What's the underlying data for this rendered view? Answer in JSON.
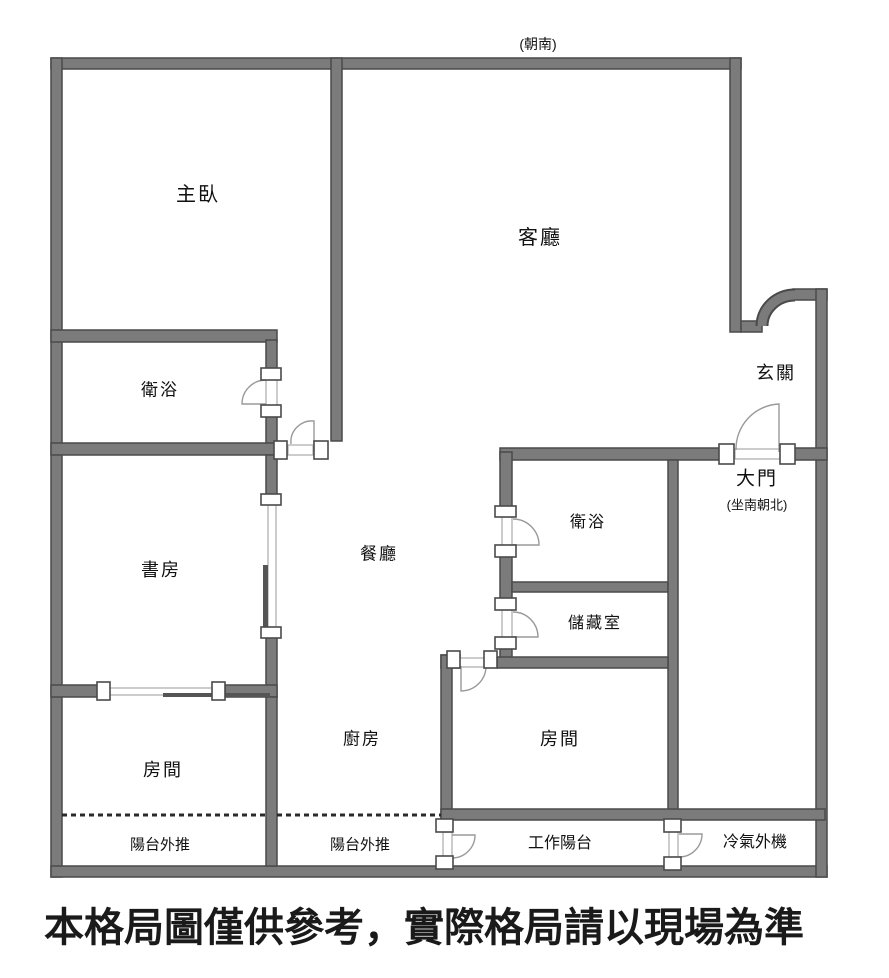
{
  "plan": {
    "orientation_label": "(朝南)",
    "entrance": {
      "door_label": "大門",
      "door_sub_label": "(坐南朝北)"
    },
    "rooms": [
      {
        "name": "master-bedroom",
        "label": "主臥"
      },
      {
        "name": "living-room",
        "label": "客廳"
      },
      {
        "name": "bathroom-1",
        "label": "衛浴"
      },
      {
        "name": "study",
        "label": "書房"
      },
      {
        "name": "dining-room",
        "label": "餐廳"
      },
      {
        "name": "entrance-hall",
        "label": "玄關"
      },
      {
        "name": "bathroom-2",
        "label": "衛浴"
      },
      {
        "name": "storage-room",
        "label": "儲藏室"
      },
      {
        "name": "kitchen",
        "label": "廚房"
      },
      {
        "name": "bedroom-left",
        "label": "房間"
      },
      {
        "name": "bedroom-right",
        "label": "房間"
      },
      {
        "name": "balcony-left",
        "label": "陽台外推"
      },
      {
        "name": "balcony-middle",
        "label": "陽台外推"
      },
      {
        "name": "work-balcony",
        "label": "工作陽台"
      },
      {
        "name": "ac-outdoor-unit",
        "label": "冷氣外機"
      }
    ],
    "disclaimer": "本格局圖僅供參考，實際格局請以現場為準",
    "colors": {
      "wall_fill": "#7b7b7b",
      "wall_outline": "#4a4a4a",
      "door_line": "#9a9a9a",
      "slide_panel": "#555555",
      "dash_line": "#2a2a2a",
      "text": "#111111"
    }
  }
}
